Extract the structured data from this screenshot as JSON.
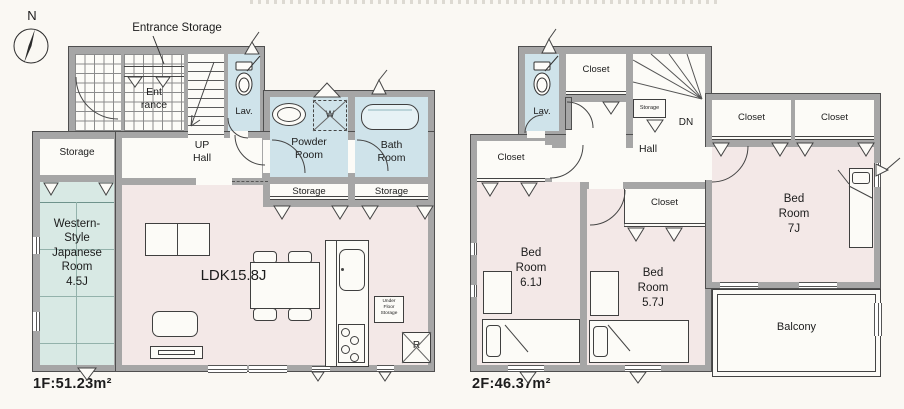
{
  "colors": {
    "paper": "#faf8f3",
    "wall": "#a6a6a6",
    "wall_edge": "#4f4f4f",
    "room_pink": "#f3e8e7",
    "wet_blue": "#cfe3ea",
    "tatami_green": "#d8e9e4",
    "ink": "#1c1c1c"
  },
  "compass": {
    "n": "N"
  },
  "annotations": {
    "entrance_storage": "Entrance Storage"
  },
  "floor1": {
    "area": "1F:51.23m²",
    "entrance": "Ent\nrance",
    "up_hall": "UP\nHall",
    "lav": "Lav.",
    "powder": "Powder\nRoom",
    "bath": "Bath\nRoom",
    "storage": "Storage",
    "japanese_room": "Western-\nStyle\nJapanese\nRoom\n4.5J",
    "ldk": "LDK15.8J",
    "under_floor": "Under\nFloor\nStorage",
    "washer": "W",
    "fridge": "R"
  },
  "floor2": {
    "area": "2F:46.37m²",
    "lav": "Lav.",
    "closet": "Closet",
    "storage": "Storage",
    "dn": "DN",
    "hall": "Hall",
    "bed7": "Bed\nRoom\n7J",
    "bed61": "Bed\nRoom\n6.1J",
    "bed57": "Bed\nRoom\n5.7J",
    "balcony": "Balcony"
  }
}
